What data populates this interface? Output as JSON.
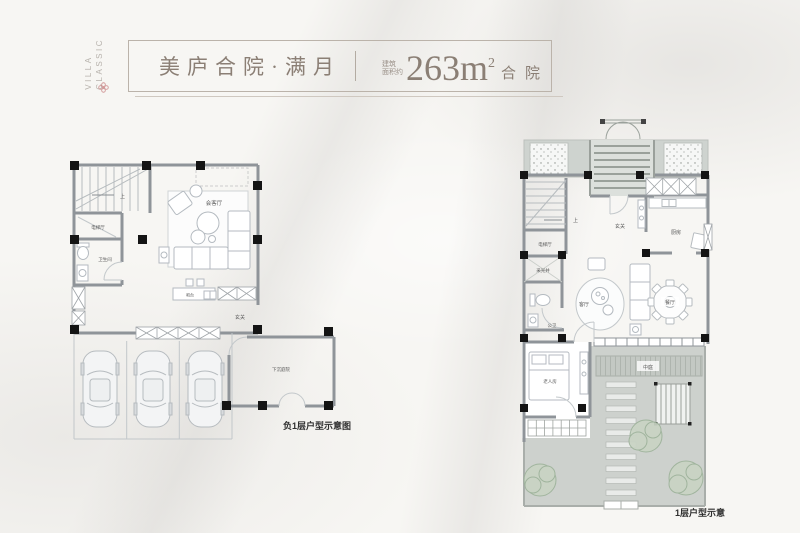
{
  "brand": {
    "line1": "CLASSIC",
    "line2": "VILLA"
  },
  "icons": {
    "flower": "✿"
  },
  "header": {
    "title": "美庐合院·满月",
    "area_label_line1": "建筑",
    "area_label_line2": "面积约",
    "area_number": "263",
    "area_unit": "m",
    "area_exponent": "2",
    "product_type": "合院"
  },
  "plans": {
    "basement": {
      "caption": "负1层户型示意图",
      "labels": {
        "stairs_up": "上",
        "elevator_hall": "电梯厅",
        "bathroom": "卫生间",
        "reception": "会客厅",
        "bar": "吧台",
        "foyer": "玄关",
        "sunken_courtyard": "下沉庭院"
      }
    },
    "first_floor": {
      "caption": "1层户型示意",
      "labels": {
        "stairs_up": "上",
        "elevator_hall": "电梯厅",
        "light_well": "采光井",
        "guest_bathroom": "公卫",
        "foyer": "玄关",
        "kitchen": "厨房",
        "living_room": "客厅",
        "dining_room": "餐厅",
        "elder_bedroom": "老人房",
        "central_courtyard": "中庭"
      }
    }
  },
  "colors": {
    "background": "#f7f6f3",
    "accent_text": "#8b7f75",
    "wall": "#8f9499",
    "column": "#141414",
    "courtyard_fill": "#ced3cf",
    "tree": "#9db29a",
    "flower": "#c98484",
    "caption": "#2e2e2e"
  }
}
